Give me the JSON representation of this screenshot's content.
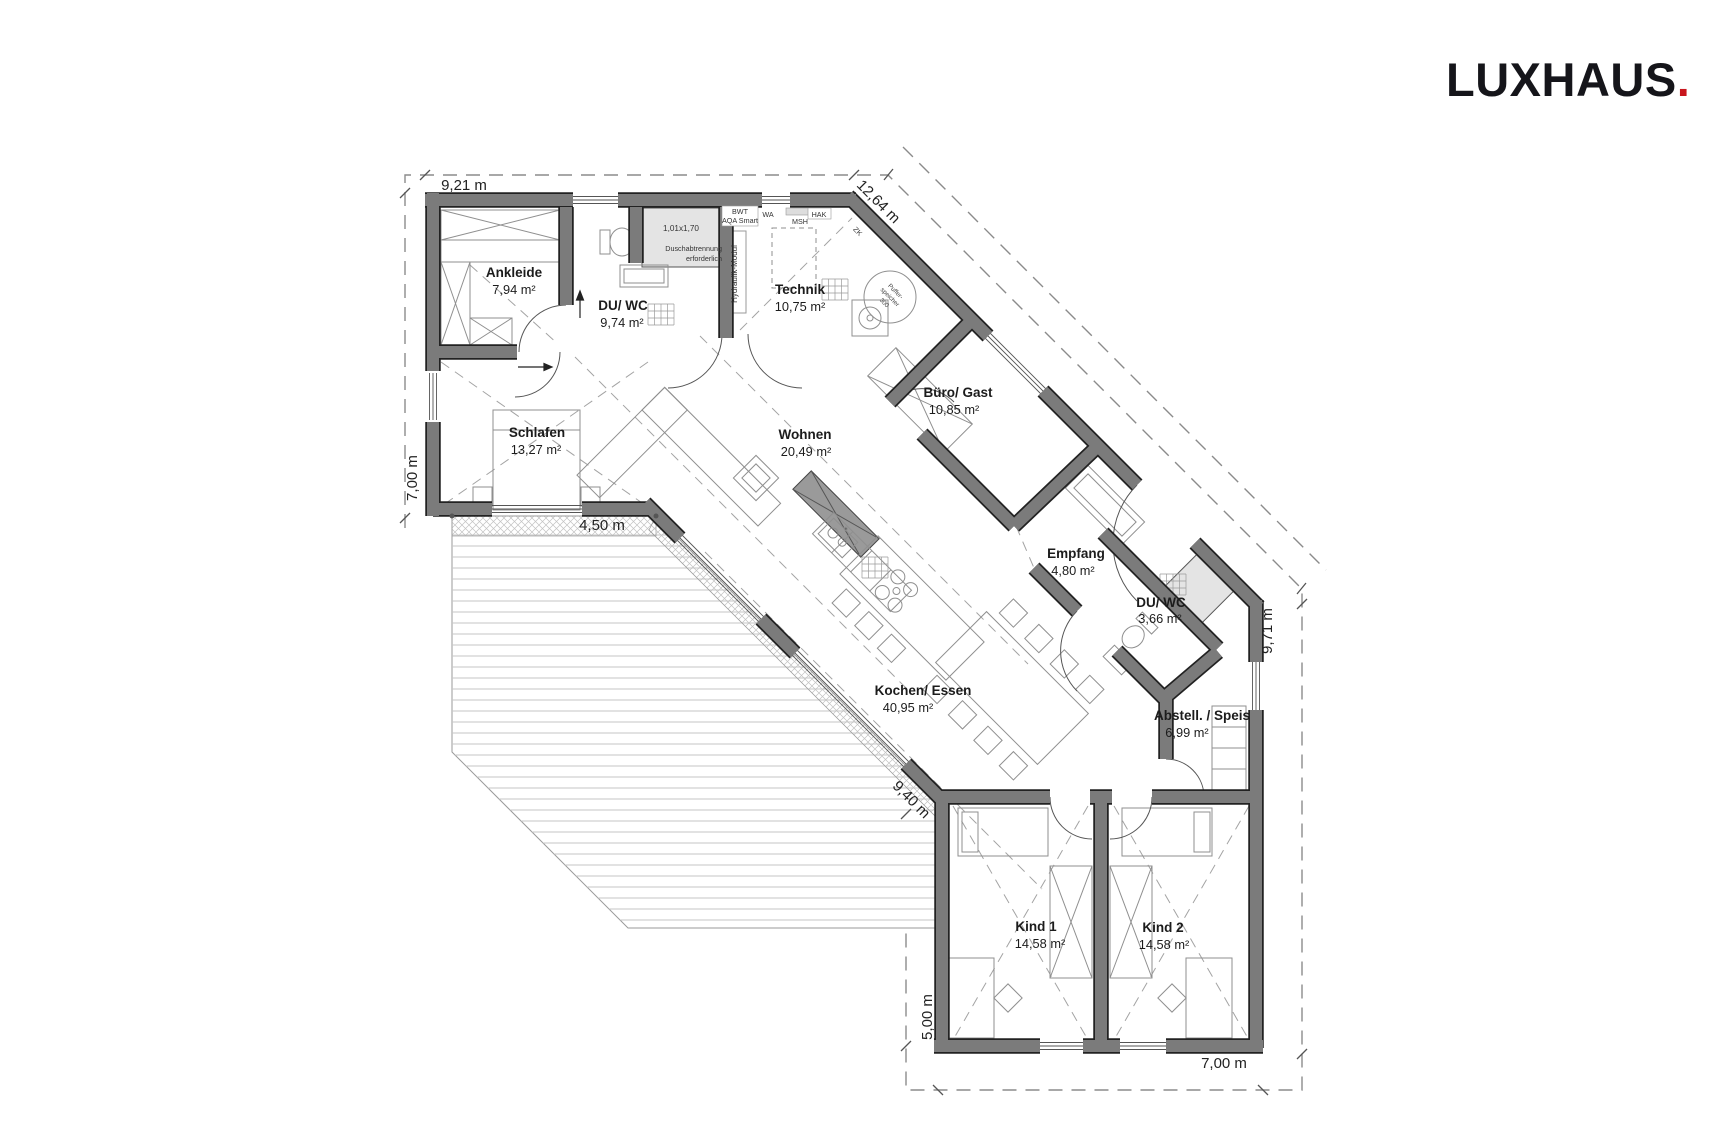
{
  "logo": {
    "bold": "LUX",
    "light": "HAUS",
    "dot": ".",
    "dot_color": "#C8161D"
  },
  "rooms": {
    "ankleide": {
      "name": "Ankleide",
      "area": "7,94 m²"
    },
    "du_wc_1": {
      "name": "DU/ WC",
      "area": "9,74 m²"
    },
    "technik": {
      "name": "Technik",
      "area": "10,75 m²"
    },
    "buero_gast": {
      "name": "Büro/ Gast",
      "area": "10,85 m²"
    },
    "schlafen": {
      "name": "Schlafen",
      "area": "13,27 m²"
    },
    "wohnen": {
      "name": "Wohnen",
      "area": "20,49 m²"
    },
    "empfang": {
      "name": "Empfang",
      "area": "4,80 m²"
    },
    "du_wc_2": {
      "name": "DU/ WC",
      "area": "3,66 m²"
    },
    "kochen_essen": {
      "name": "Kochen/ Essen",
      "area": "40,95 m²"
    },
    "abstell_speis": {
      "name": "Abstell. / Speis",
      "area": "6,99 m²"
    },
    "kind1": {
      "name": "Kind 1",
      "area": "14,58 m²"
    },
    "kind2": {
      "name": "Kind 2",
      "area": "14,58 m²"
    }
  },
  "dimensions": {
    "top": "9,21 m",
    "ne_diagonal": "12,64 m",
    "left": "7,00 m",
    "terrace_top": "4,50 m",
    "terrace_diagonal": "9,40 m",
    "right": "9,71 m",
    "kids_left": "5,00 m",
    "bottom": "7,00 m"
  },
  "annotations": {
    "shower_size": "1,01x1,70",
    "shower_note_1": "Duschabtrennung",
    "shower_note_2": "erforderlich",
    "hydraulik_modul": "Hydraulik-Modul",
    "bwt_1": "BWT",
    "bwt_2": "AQA Smart",
    "wa": "WA",
    "msh": "MSH",
    "hak": "HAK",
    "zk": "ZK",
    "puffer_1": "Puffer-",
    "puffer_2": "speicher",
    "puffer_3": "300"
  },
  "colors": {
    "wall": "#7b7b7b",
    "accent_red": "#C8161D"
  }
}
